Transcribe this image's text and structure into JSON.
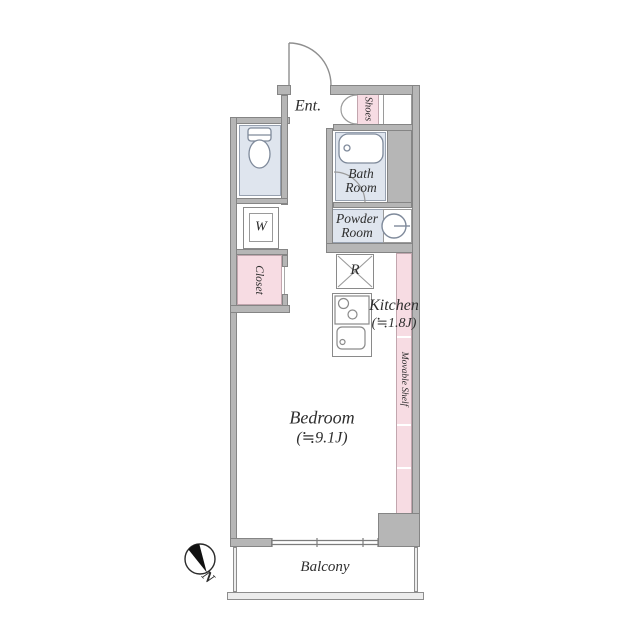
{
  "plan": {
    "type": "apartment-floor-plan",
    "rooms": {
      "entrance": {
        "label": "Ent."
      },
      "shoes": {
        "label": "Shoes"
      },
      "bath": {
        "label_line1": "Bath",
        "label_line2": "Room"
      },
      "powder": {
        "label_line1": "Powder",
        "label_line2": "Room"
      },
      "washer": {
        "label": "W"
      },
      "closet": {
        "label": "Closet"
      },
      "refrigerator": {
        "label": "R"
      },
      "kitchen": {
        "label": "Kitchen",
        "size": "(≒1.8J)"
      },
      "movable_shelf": {
        "label": "Movable Shelf"
      },
      "bedroom": {
        "label": "Bedroom",
        "size": "(≒9.1J)"
      },
      "balcony": {
        "label": "Balcony"
      }
    },
    "compass": {
      "label": "N",
      "direction": "north points lower-right"
    },
    "colors": {
      "wall": "#b6b6b6",
      "wet_area_fill": "#dfe5ee",
      "storage_fill": "#f7dce3",
      "background": "#ffffff",
      "line": "#858585"
    }
  }
}
